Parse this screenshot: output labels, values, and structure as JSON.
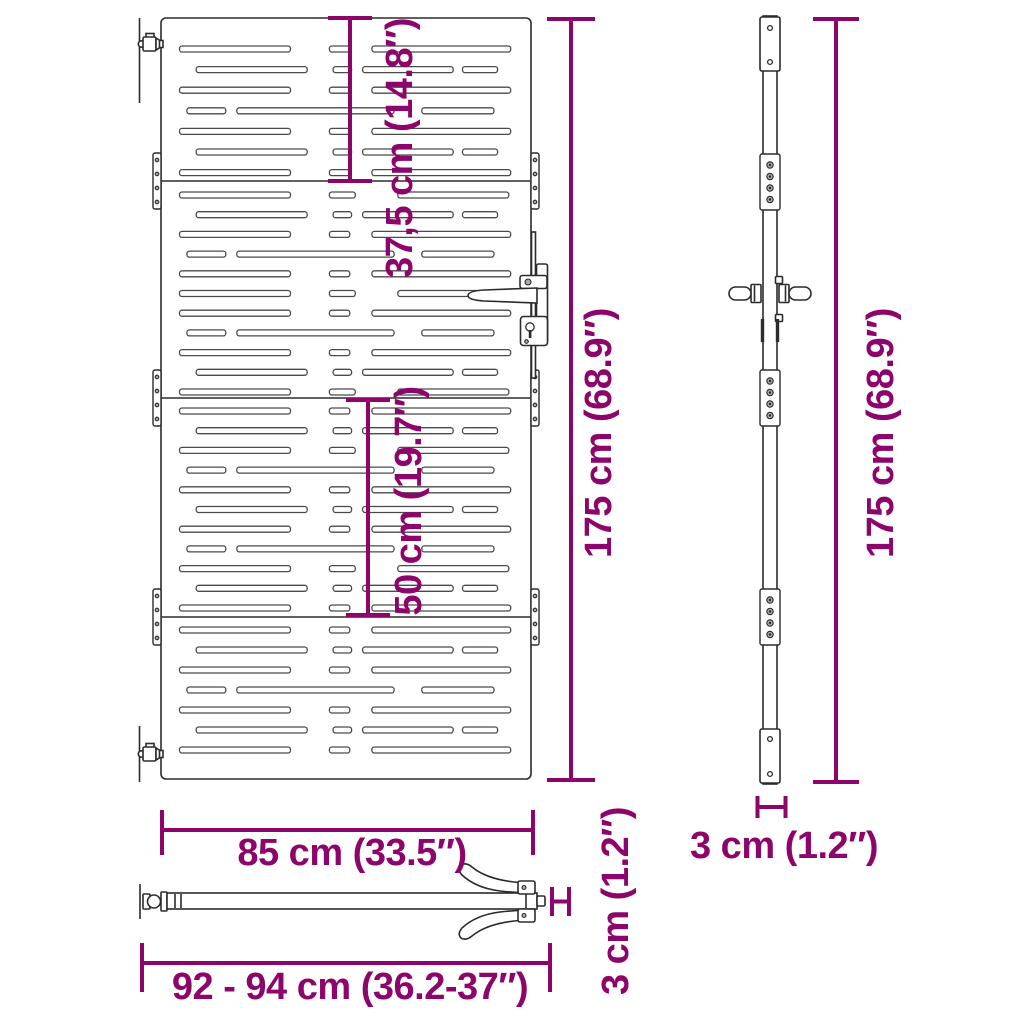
{
  "figure": {
    "type": "product-dimension-diagram",
    "subject": "slatted garden gate with handle and hinges (front, side and top views)",
    "colors": {
      "accent": "#8d056b",
      "line": "#2b2b2b",
      "background": "#ffffff"
    },
    "labels": {
      "section_top_height": "37,5 cm (14.8″)",
      "section_mid_height": "50 cm (19.7″)",
      "total_height_front": "175 cm (68.9″)",
      "total_height_side": "175 cm (68.9″)",
      "gate_width": "85 cm (33.5″)",
      "overall_width": "92 - 94 cm (36.2-37″)",
      "depth_side": "3 cm (1.2″)",
      "depth_top": "3 cm (1.2″)"
    },
    "gate_pattern": {
      "x": 161,
      "width": 370,
      "slat_height": 6,
      "templates": {
        "A": [
          [
            0.05,
            0.3
          ],
          [
            0.455,
            0.055
          ],
          [
            0.57,
            0.375
          ]
        ],
        "B": [
          [
            0.095,
            0.3
          ],
          [
            0.465,
            0.05
          ],
          [
            0.545,
            0.245
          ],
          [
            0.815,
            0.095
          ]
        ],
        "D": [
          [
            0.07,
            0.105
          ],
          [
            0.205,
            0.425
          ],
          [
            0.705,
            0.195
          ]
        ],
        "E": [
          [
            0.05,
            0.3
          ],
          [
            0.455,
            0.07
          ],
          [
            0.64,
            0.3
          ]
        ]
      },
      "panels": [
        {
          "start": 46,
          "pitch": 20.6,
          "rows": [
            "A",
            "B",
            "A",
            "D",
            "A",
            "B",
            "A"
          ]
        },
        {
          "start": 192,
          "pitch": 19.7,
          "rows": [
            "E",
            "B",
            "A",
            "D",
            "A",
            "E",
            "A",
            "D",
            "A",
            "B",
            "E"
          ]
        },
        {
          "start": 408,
          "pitch": 19.7,
          "rows": [
            "A",
            "B",
            "E",
            "D",
            "A",
            "B",
            "A",
            "D",
            "E",
            "B",
            "A"
          ]
        },
        {
          "start": 627,
          "pitch": 20.0,
          "rows": [
            "A",
            "B",
            "A",
            "D",
            "A",
            "B",
            "A"
          ]
        }
      ],
      "division_y": [
        181,
        398,
        617
      ],
      "plate_x": [
        153,
        531
      ]
    },
    "side_blocks_y": [
      154,
      370,
      589
    ]
  }
}
